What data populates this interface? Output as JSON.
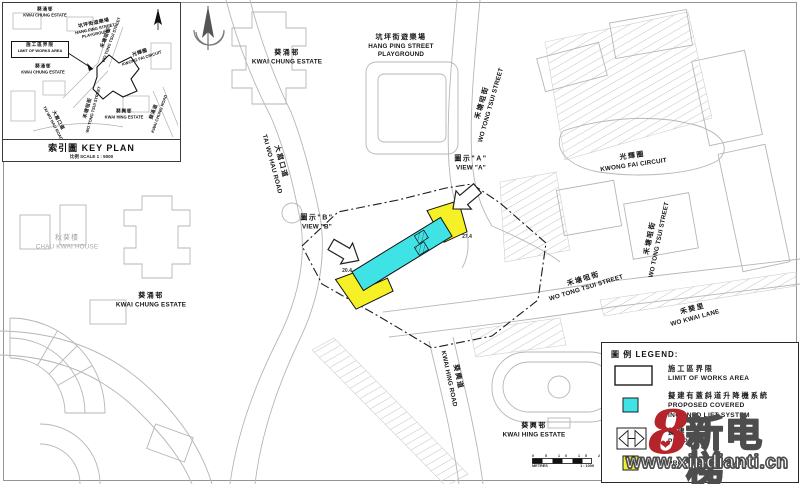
{
  "key_plan": {
    "title": "索引圖 KEY PLAN",
    "scale": "比例 SCALE  1 : 5000",
    "limit_box": {
      "zh": "施工區界限",
      "en": "LIMIT OF WORKS AREA"
    },
    "labels": [
      {
        "zh": "葵涌邨",
        "en": "KWAI CHUNG ESTATE"
      },
      {
        "zh": "坑坪街遊樂場",
        "en1": "HANG PING STREET",
        "en2": "PLAYGROUND"
      },
      {
        "zh": "禾塘咀街",
        "en": "WO TONG TSUI STREET"
      },
      {
        "zh": "光輝圈",
        "en": "KWONG FAI CIRCUIT"
      },
      {
        "zh": "葵涌邨",
        "en": "KWAI CHUNG ESTATE"
      },
      {
        "zh": "大窩口道",
        "en": "TAI WO HAU ROAD"
      },
      {
        "zh": "禾塘咀街",
        "en": "WO TONG TSUI STREET"
      },
      {
        "zh": "葵興邨",
        "en": "KWAI HING ESTATE"
      },
      {
        "zh": "葵涌道",
        "en": "KWAI CHUNG ROAD"
      }
    ]
  },
  "map": {
    "labels": [
      {
        "zh": "葵涌邨",
        "en": "KWAI CHUNG ESTATE"
      },
      {
        "zh": "坑坪街遊樂場",
        "en1": "HANG PING STREET",
        "en2": "PLAYGROUND"
      },
      {
        "zh": "禾塘咀街",
        "en": "WO TONG TSUI STREET"
      },
      {
        "zh": "光輝圈",
        "en": "KWONG FAI CIRCUIT"
      },
      {
        "zh": "禾塘咀街",
        "en": "WO TONG TSUI STREET"
      },
      {
        "zh": "禾塘咀街",
        "en": "WO TONG TSUI STREET"
      },
      {
        "zh": "禾葵里",
        "en": "WO KWAI LANE"
      },
      {
        "zh": "葵涌邨",
        "en": "KWAI CHUNG ESTATE"
      },
      {
        "zh": "秋葵樓",
        "en": "CHAU KWAI HOUSE"
      },
      {
        "zh": "大窩口道",
        "en": "TAI WO HAU ROAD"
      },
      {
        "zh": "葵興道",
        "en": "KWAI HING ROAD"
      },
      {
        "zh": "葵興邨",
        "en": "KWAI HING ESTATE"
      }
    ],
    "views": {
      "b": {
        "zh": "圖示\"B\"",
        "en": "VIEW \"B\""
      },
      "a": {
        "zh": "圖示\"A\"",
        "en": "VIEW \"A\""
      }
    },
    "spot_levels": {
      "upper": "27.4",
      "lower": "20.4"
    }
  },
  "scale_bar": {
    "ticks": "0 5 10 15 20 25",
    "unit": "METRES",
    "ratio": "1 : 1000"
  },
  "legend": {
    "title": "圖 例 LEGEND:",
    "items": [
      {
        "zh": "施工區界限",
        "en1": "LIMIT OF WORKS AREA",
        "en2": ""
      },
      {
        "zh": "擬建有蓋斜道升降機系統",
        "en1": "PROPOSED COVERED",
        "en2": "INCLINED LIFT SYSTEM"
      },
      {
        "zh": "擬建",
        "en1": "PROPOSED",
        "en2": ""
      },
      {
        "zh": "",
        "en1": "PROPOSED FOOTPATH",
        "en2": ""
      }
    ]
  },
  "watermark": {
    "figure": "8",
    "brand": "新电梯",
    "url": "www.xindianti.cn"
  },
  "colors": {
    "lift_cyan": "#3FE3E6",
    "footpath_yellow": "#F5F126",
    "watermark_red": "#B5242B",
    "linework_gray": "#B6B6B6"
  }
}
